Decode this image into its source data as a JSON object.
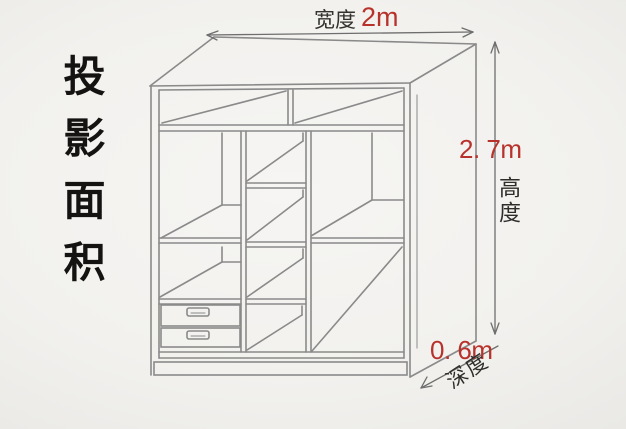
{
  "canvas": {
    "width": 626,
    "height": 429,
    "background": "#f2f1ee"
  },
  "colors": {
    "accent_red": "#b8322c",
    "cabinet_line": "#8a8a8a",
    "dimension_line": "#6e6e6e",
    "label_dark": "#34322f",
    "side_text": "#141311"
  },
  "side_label": {
    "text": "投影面积"
  },
  "dimensions": {
    "width": {
      "label": "宽度",
      "value": "2m"
    },
    "height": {
      "value": "2. 7m",
      "label": "高度"
    },
    "depth": {
      "value": "0. 6m",
      "label": "深度"
    }
  }
}
